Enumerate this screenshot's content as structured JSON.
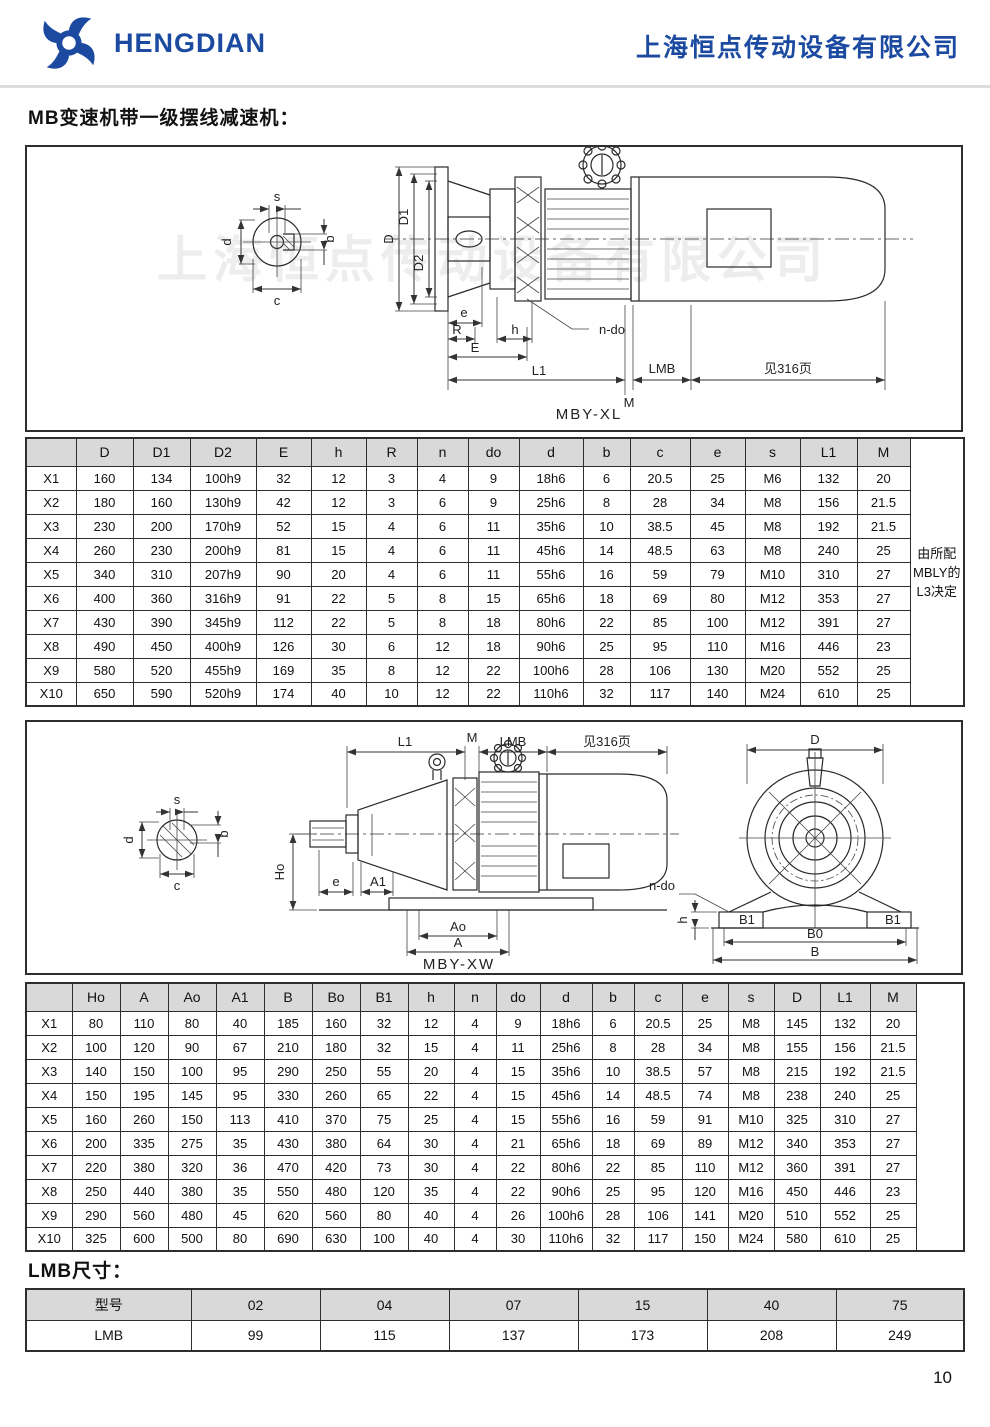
{
  "header": {
    "logo_text": "HENGDIAN",
    "company_name": "上海恒点传动设备有限公司",
    "brand_color": "#1b4aa0"
  },
  "page": {
    "title": "MB变速机带一级摆线减速机：",
    "lmb_section_title": "LMB尺寸：",
    "page_number": "10"
  },
  "drawing1": {
    "caption": "MBY-XL",
    "watermark": "上海恒点传动设备有限公司",
    "dims": {
      "s": "s",
      "b": "b",
      "d": "d",
      "c": "c",
      "D": "D",
      "D1": "D1",
      "D2": "D2",
      "e": "e",
      "R": "R",
      "h": "h",
      "E": "E",
      "L1": "L1",
      "M": "M",
      "LMB": "LMB",
      "ndo": "n-do",
      "see": "见316页"
    }
  },
  "drawing2": {
    "caption": "MBY-XW",
    "dims": {
      "s": "s",
      "b": "b",
      "d": "d",
      "c": "c",
      "L1": "L1",
      "M": "M",
      "LMB": "LMB",
      "see": "见316页",
      "Ho": "Ho",
      "e": "e",
      "A1": "A1",
      "Ao": "Ao",
      "A": "A",
      "D": "D",
      "ndo": "n-do",
      "h": "h",
      "B1": "B1",
      "B0": "B0",
      "B": "B"
    }
  },
  "table1": {
    "columns": [
      "",
      "D",
      "D1",
      "D2",
      "E",
      "h",
      "R",
      "n",
      "do",
      "d",
      "b",
      "c",
      "e",
      "s",
      "L1",
      "M"
    ],
    "note": "由所配MBLY的L3决定",
    "rows": [
      [
        "X1",
        160,
        134,
        "100h9",
        32,
        12,
        3,
        4,
        9,
        "18h6",
        6,
        20.5,
        25,
        "M6",
        132,
        20
      ],
      [
        "X2",
        180,
        160,
        "130h9",
        42,
        12,
        3,
        6,
        9,
        "25h6",
        8,
        28,
        34,
        "M8",
        156,
        21.5
      ],
      [
        "X3",
        230,
        200,
        "170h9",
        52,
        15,
        4,
        6,
        11,
        "35h6",
        10,
        38.5,
        45,
        "M8",
        192,
        21.5
      ],
      [
        "X4",
        260,
        230,
        "200h9",
        81,
        15,
        4,
        6,
        11,
        "45h6",
        14,
        48.5,
        63,
        "M8",
        240,
        25
      ],
      [
        "X5",
        340,
        310,
        "207h9",
        90,
        20,
        4,
        6,
        11,
        "55h6",
        16,
        59,
        79,
        "M10",
        310,
        27
      ],
      [
        "X6",
        400,
        360,
        "316h9",
        91,
        22,
        5,
        8,
        15,
        "65h6",
        18,
        69,
        80,
        "M12",
        353,
        27
      ],
      [
        "X7",
        430,
        390,
        "345h9",
        112,
        22,
        5,
        8,
        18,
        "80h6",
        22,
        85,
        100,
        "M12",
        391,
        27
      ],
      [
        "X8",
        490,
        450,
        "400h9",
        126,
        30,
        6,
        12,
        18,
        "90h6",
        25,
        95,
        110,
        "M16",
        446,
        23
      ],
      [
        "X9",
        580,
        520,
        "455h9",
        169,
        35,
        8,
        12,
        22,
        "100h6",
        28,
        106,
        130,
        "M20",
        552,
        25
      ],
      [
        "X10",
        650,
        590,
        "520h9",
        174,
        40,
        10,
        12,
        22,
        "110h6",
        32,
        117,
        140,
        "M24",
        610,
        25
      ]
    ]
  },
  "table2": {
    "columns": [
      "",
      "Ho",
      "A",
      "Ao",
      "A1",
      "B",
      "Bo",
      "B1",
      "h",
      "n",
      "do",
      "d",
      "b",
      "c",
      "e",
      "s",
      "D",
      "L1",
      "M"
    ],
    "note": "",
    "rows": [
      [
        "X1",
        80,
        110,
        80,
        40,
        185,
        160,
        32,
        12,
        4,
        9,
        "18h6",
        6,
        20.5,
        25,
        "M8",
        145,
        132,
        20
      ],
      [
        "X2",
        100,
        120,
        90,
        67,
        210,
        180,
        32,
        15,
        4,
        11,
        "25h6",
        8,
        28,
        34,
        "M8",
        155,
        156,
        21.5
      ],
      [
        "X3",
        140,
        150,
        100,
        95,
        290,
        250,
        55,
        20,
        4,
        15,
        "35h6",
        10,
        38.5,
        57,
        "M8",
        215,
        192,
        21.5
      ],
      [
        "X4",
        150,
        195,
        145,
        95,
        330,
        260,
        65,
        22,
        4,
        15,
        "45h6",
        14,
        48.5,
        74,
        "M8",
        238,
        240,
        25
      ],
      [
        "X5",
        160,
        260,
        150,
        113,
        410,
        370,
        75,
        25,
        4,
        15,
        "55h6",
        16,
        59,
        91,
        "M10",
        325,
        310,
        27
      ],
      [
        "X6",
        200,
        335,
        275,
        35,
        430,
        380,
        64,
        30,
        4,
        21,
        "65h6",
        18,
        69,
        89,
        "M12",
        340,
        353,
        27
      ],
      [
        "X7",
        220,
        380,
        320,
        36,
        470,
        420,
        73,
        30,
        4,
        22,
        "80h6",
        22,
        85,
        110,
        "M12",
        360,
        391,
        27
      ],
      [
        "X8",
        250,
        440,
        380,
        35,
        550,
        480,
        120,
        35,
        4,
        22,
        "90h6",
        25,
        95,
        120,
        "M16",
        450,
        446,
        23
      ],
      [
        "X9",
        290,
        560,
        480,
        45,
        620,
        560,
        80,
        40,
        4,
        26,
        "100h6",
        28,
        106,
        141,
        "M20",
        510,
        552,
        25
      ],
      [
        "X10",
        325,
        600,
        500,
        80,
        690,
        630,
        100,
        40,
        4,
        30,
        "110h6",
        32,
        117,
        150,
        "M24",
        580,
        610,
        25
      ]
    ]
  },
  "lmb_table": {
    "columns": [
      "型号",
      "02",
      "04",
      "07",
      "15",
      "40",
      "75"
    ],
    "rows": [
      [
        "LMB",
        "99",
        "115",
        "137",
        "173",
        "208",
        "249"
      ]
    ]
  }
}
